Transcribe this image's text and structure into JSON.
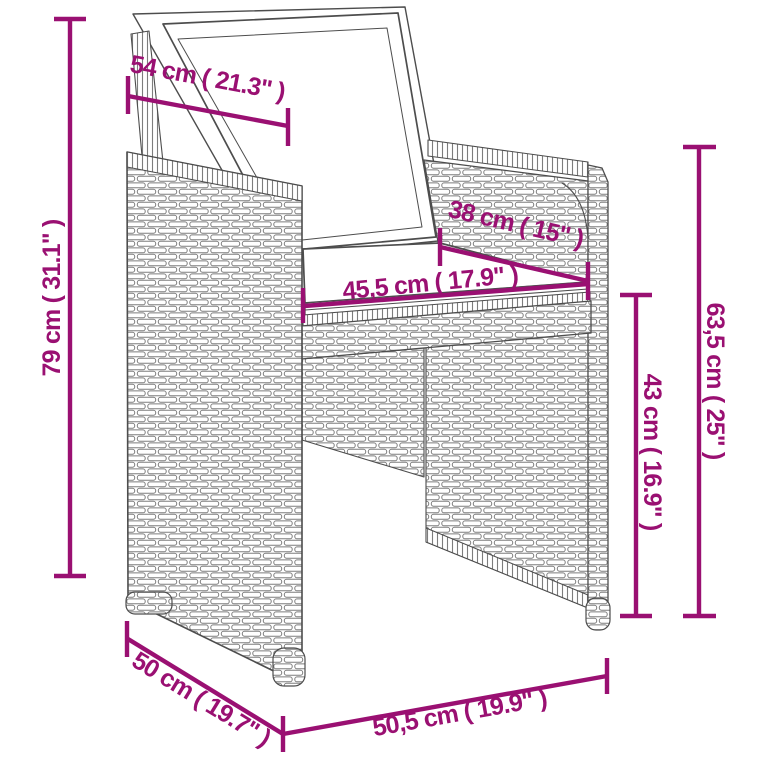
{
  "figure": {
    "subject": "wicker-armchair-dimension-diagram",
    "background": "#FFFFFF"
  },
  "colors": {
    "annotation": "#9A1072",
    "drawing_line": "#4D4D4D",
    "texture_line": "#7D7D7D"
  },
  "dimensions": {
    "back_width": "54 cm ( 21.3\" )",
    "overall_height": "79 cm ( 31.1\" )",
    "seat_depth": "38 cm ( 15\" )",
    "seat_width": "45,5 cm ( 17.9\" )",
    "backrest_height": "63,5 cm ( 25\" )",
    "seat_to_arm_height": "43 cm ( 16.9\" )",
    "overall_depth": "50 cm ( 19.7\" )",
    "overall_width": "50,5 cm ( 19.9\" )"
  }
}
